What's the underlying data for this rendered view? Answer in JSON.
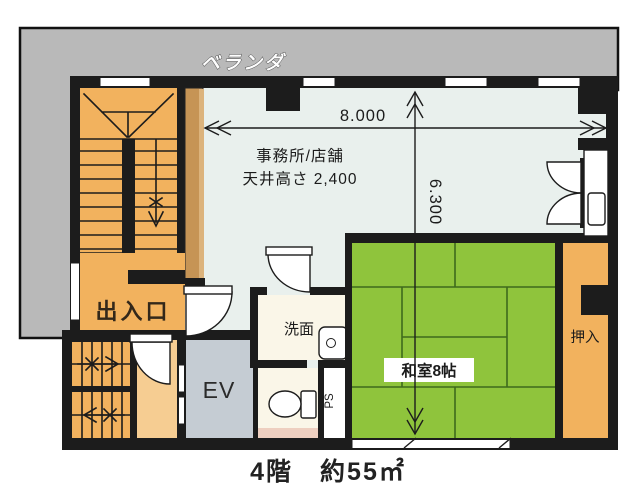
{
  "plan": {
    "veranda_label": "ベランダ",
    "office": {
      "name": "事務所/店舗",
      "ceiling": "天井高さ 2,400"
    },
    "dimensions": {
      "width": "8.000",
      "height": "6.300"
    },
    "rooms": {
      "entrance": "出入口",
      "elevator": "EV",
      "washroom": "洗面",
      "tatami": "和室8帖",
      "closet": "押入",
      "pipe_space": "PS"
    },
    "caption": "4階　約55㎡",
    "colors": {
      "veranda": "#b9b9b9",
      "office_floor": "#e9f0ed",
      "stairs": "#f2b25e",
      "hall": "#f6cd92",
      "partition": "#c69455",
      "partition_edge": "#dcb37c",
      "elevator": "#c5ccd3",
      "sanitary_floor": "#faf6e8",
      "tatami": "#8fc43c",
      "closet": "#f2b25e",
      "pink_strip": "#eecfc0",
      "walls": "#1c1c1c"
    }
  }
}
